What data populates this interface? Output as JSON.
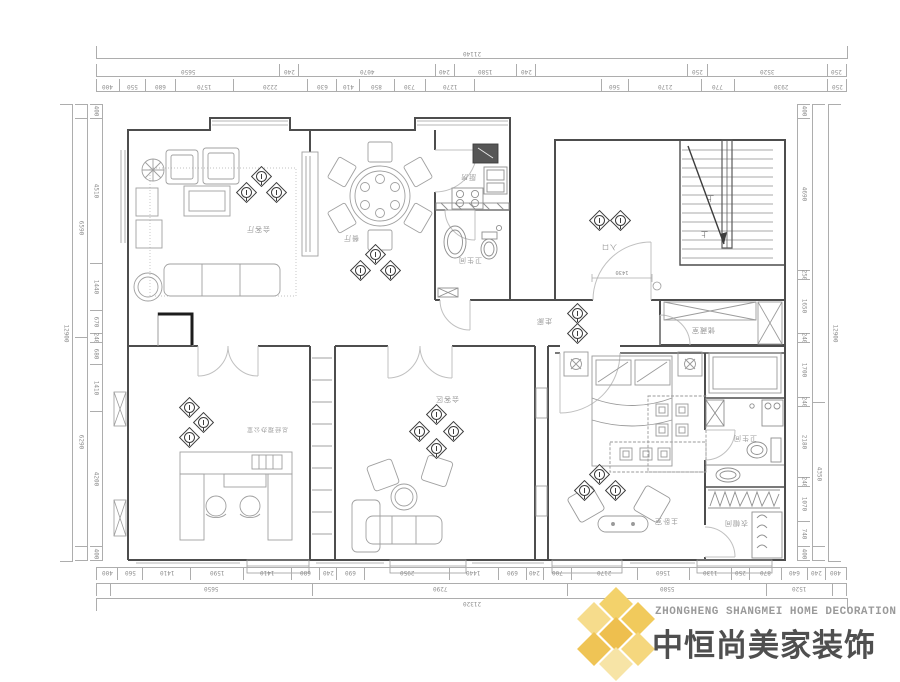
{
  "logo": {
    "line_en": "ZHONGHENG SHANGMEI HOME DECORATION",
    "line_cn": "中恒尚美家装饰",
    "colors": {
      "gold": "#f0c95c",
      "gold_light": "#f7e4a6",
      "gold_dark": "#eebf4e"
    }
  },
  "rooms": {
    "living": {
      "label": "会客厅"
    },
    "dining": {
      "label": "餐厅"
    },
    "kitchen": {
      "label": "厨房"
    },
    "bath1": {
      "label": "卫生间"
    },
    "entry": {
      "label": "入口"
    },
    "corridor": {
      "label": "走廊"
    },
    "storage": {
      "label": "储藏室"
    },
    "office": {
      "label": "总经理办公室"
    },
    "meeting": {
      "label": "会客区"
    },
    "bedroom": {
      "label": "主卧室"
    },
    "bath2": {
      "label": "卫生间"
    },
    "closet": {
      "label": "衣帽间"
    }
  },
  "plan": {
    "stair_up_label": "上",
    "entry_width": "1430"
  },
  "dims": {
    "top": {
      "overall": "21140",
      "mid": [
        {
          "v": "5650",
          "w": 5650
        },
        {
          "v": "240",
          "w": 240
        },
        {
          "v": "4070",
          "w": 4070
        },
        {
          "v": "240",
          "w": 240
        },
        {
          "v": "1580",
          "w": 1580
        },
        {
          "v": "240",
          "w": 240
        },
        {
          "v": "",
          "w": 5100
        },
        {
          "v": "250",
          "w": 250
        },
        {
          "v": "3520",
          "w": 3520
        },
        {
          "v": "250",
          "w": 250
        }
      ],
      "inner": [
        {
          "v": "400",
          "w": 400
        },
        {
          "v": "550",
          "w": 550
        },
        {
          "v": "680",
          "w": 680
        },
        {
          "v": "1570",
          "w": 1570
        },
        {
          "v": "2220",
          "w": 2220
        },
        {
          "v": "630",
          "w": 630
        },
        {
          "v": "410",
          "w": 410
        },
        {
          "v": "850",
          "w": 850
        },
        {
          "v": "730",
          "w": 730
        },
        {
          "v": "1270",
          "w": 1270
        },
        {
          "v": "",
          "w": 4690
        },
        {
          "v": "560",
          "w": 560
        },
        {
          "v": "2170",
          "w": 2170
        },
        {
          "v": "770",
          "w": 770
        },
        {
          "v": "2930",
          "w": 2930
        },
        {
          "v": "250",
          "w": 250
        }
      ]
    },
    "bottom": {
      "overall": "21320",
      "mid": [
        {
          "v": "",
          "w": 400
        },
        {
          "v": "5650",
          "w": 5650
        },
        {
          "v": "7290",
          "w": 7290
        },
        {
          "v": "5580",
          "w": 5580
        },
        {
          "v": "1520",
          "w": 1520
        },
        {
          "v": "",
          "w": 400
        }
      ],
      "inner": [
        {
          "v": "400",
          "w": 400
        },
        {
          "v": "560",
          "w": 560
        },
        {
          "v": "1410",
          "w": 1410
        },
        {
          "v": "1590",
          "w": 1590
        },
        {
          "v": "1410",
          "w": 1410
        },
        {
          "v": "680",
          "w": 680
        },
        {
          "v": "240",
          "w": 240
        },
        {
          "v": "690",
          "w": 690
        },
        {
          "v": "2950",
          "w": 2950
        },
        {
          "v": "1440",
          "w": 1440
        },
        {
          "v": "690",
          "w": 690
        },
        {
          "v": "240",
          "w": 240
        },
        {
          "v": "700",
          "w": 700
        },
        {
          "v": "2170",
          "w": 2170
        },
        {
          "v": "1560",
          "w": 1560
        },
        {
          "v": "1130",
          "w": 1130
        },
        {
          "v": "250",
          "w": 250
        },
        {
          "v": "870",
          "w": 870
        },
        {
          "v": "640",
          "w": 640
        },
        {
          "v": "240",
          "w": 240
        },
        {
          "v": "400",
          "w": 400
        }
      ]
    },
    "left": {
      "overall": "12900",
      "mid": [
        {
          "v": "",
          "w": 400
        },
        {
          "v": "6590",
          "w": 6590
        },
        {
          "v": "6290",
          "w": 6290
        },
        {
          "v": "",
          "w": 400
        }
      ],
      "inner": [
        {
          "v": "400",
          "w": 400
        },
        {
          "v": "4510",
          "w": 4510
        },
        {
          "v": "1440",
          "w": 1440
        },
        {
          "v": "670",
          "w": 670
        },
        {
          "v": "240",
          "w": 240
        },
        {
          "v": "680",
          "w": 680
        },
        {
          "v": "1410",
          "w": 1410
        },
        {
          "v": "4200",
          "w": 4200
        },
        {
          "v": "400",
          "w": 400
        }
      ]
    },
    "right": {
      "overall": "12900",
      "mid": [
        {
          "v": "",
          "w": 9050
        },
        {
          "v": "4350",
          "w": 4350
        },
        {
          "v": "",
          "w": 400
        }
      ],
      "inner": [
        {
          "v": "400",
          "w": 400
        },
        {
          "v": "4690",
          "w": 4690
        },
        {
          "v": "250",
          "w": 250
        },
        {
          "v": "1650",
          "w": 1650
        },
        {
          "v": "240",
          "w": 240
        },
        {
          "v": "1700",
          "w": 1700
        },
        {
          "v": "240",
          "w": 240
        },
        {
          "v": "2180",
          "w": 2180
        },
        {
          "v": "240",
          "w": 240
        },
        {
          "v": "1070",
          "w": 1070
        },
        {
          "v": "740",
          "w": 740
        },
        {
          "v": "400",
          "w": 400
        }
      ]
    }
  }
}
